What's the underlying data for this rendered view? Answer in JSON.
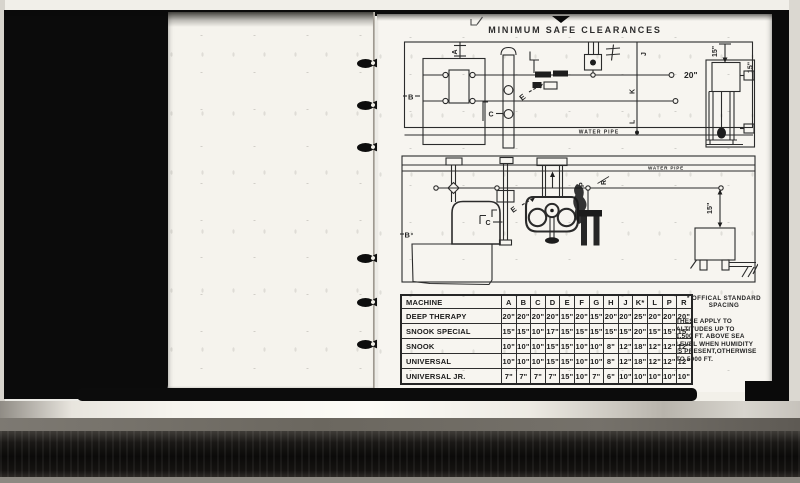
{
  "page": {
    "title": "MINIMUM SAFE CLEARANCES"
  },
  "plan_view": {
    "labels": {
      "a": "A",
      "b": "B",
      "c": "C",
      "e": "E",
      "f": "F",
      "j": "J",
      "k": "K",
      "l": "L",
      "dim_20": "20\"",
      "dim_15_top": "15\"",
      "dim_15_side": "15\"",
      "water_pipe": "WATER PIPE"
    }
  },
  "elevation_view": {
    "labels": {
      "b": "B",
      "c": "C",
      "e": "E",
      "p": "P",
      "r": "R",
      "dim_15": "15\"",
      "water_pipe": "WATER PIPE"
    }
  },
  "clearance_table": {
    "headers": [
      "MACHINE",
      "A",
      "B",
      "C",
      "D",
      "E",
      "F",
      "G",
      "H",
      "J",
      "K*",
      "L",
      "P",
      "R"
    ],
    "rows": [
      {
        "machine": "DEEP THERAPY",
        "values": [
          "20\"",
          "20\"",
          "20\"",
          "20\"",
          "15\"",
          "20\"",
          "15\"",
          "20\"",
          "20\"",
          "25\"",
          "20\"",
          "20\"",
          "20\""
        ]
      },
      {
        "machine": "SNOOK SPECIAL",
        "values": [
          "15\"",
          "15\"",
          "10\"",
          "17\"",
          "15\"",
          "15\"",
          "15\"",
          "15\"",
          "15\"",
          "20\"",
          "15\"",
          "15\"",
          "15\""
        ]
      },
      {
        "machine": "SNOOK",
        "values": [
          "10\"",
          "10\"",
          "10\"",
          "15\"",
          "15\"",
          "10\"",
          "10\"",
          "8\"",
          "12\"",
          "18\"",
          "12\"",
          "12\"",
          "12\""
        ]
      },
      {
        "machine": "UNIVERSAL",
        "values": [
          "10\"",
          "10\"",
          "10\"",
          "15\"",
          "15\"",
          "10\"",
          "10\"",
          "8\"",
          "12\"",
          "18\"",
          "12\"",
          "12\"",
          "12\""
        ]
      },
      {
        "machine": "UNIVERSAL JR.",
        "values": [
          "7\"",
          "7\"",
          "7\"",
          "7\"",
          "15\"",
          "10\"",
          "7\"",
          "6\"",
          "10\"",
          "10\"",
          "10\"",
          "10\"",
          "10\""
        ]
      }
    ]
  },
  "note": {
    "heading_line1": "* OFFICAL STANDARD",
    "heading_line2": "SPACING",
    "body_lines": [
      "THESE APPLY TO",
      "ALTITUDES UP TO",
      "1,500 FT. ABOVE SEA",
      "LEVEL WHEN HUMIDITY",
      "IS PRESENT,OTHERWISE",
      "TO 5000 FT."
    ]
  },
  "colors": {
    "ink": "#2b2b2b",
    "page": "#f7f5f0",
    "film_black": "#0a0a0a"
  }
}
